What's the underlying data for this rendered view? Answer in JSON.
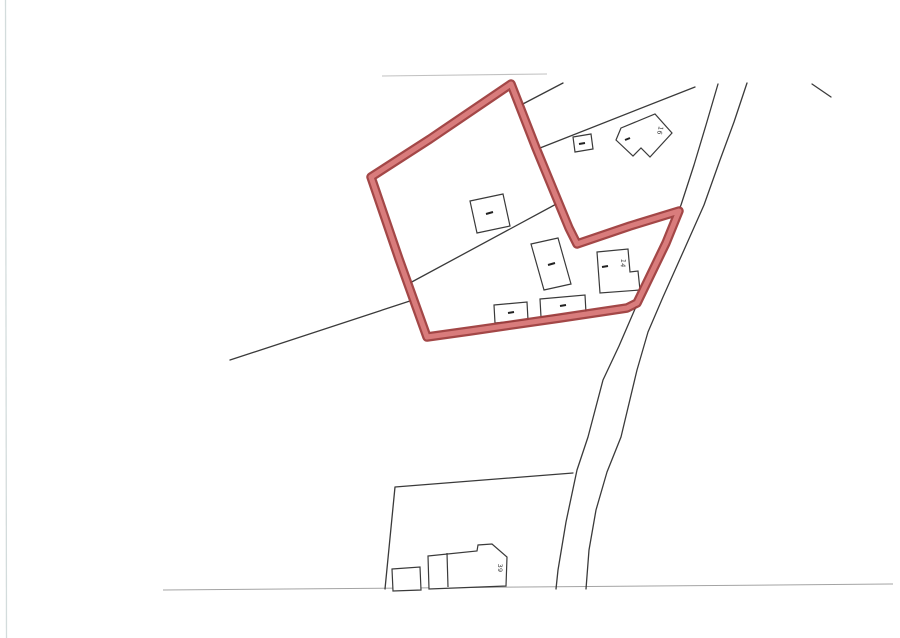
{
  "document": {
    "labels": {
      "house_16": "16",
      "house_14": "14",
      "house_39": "39"
    },
    "colors": {
      "page_background": "#ffffff",
      "highlight_outer": "#9e3d3d",
      "highlight_inner": "#d97c7c",
      "line": "#3a3a3a",
      "faint_line": "#b2b2b2",
      "bottom_line": "#9a9a9a",
      "scan_edge": "#ccd6d6",
      "building_fill": "#ffffff",
      "label_text": "#3a3a3a"
    }
  }
}
